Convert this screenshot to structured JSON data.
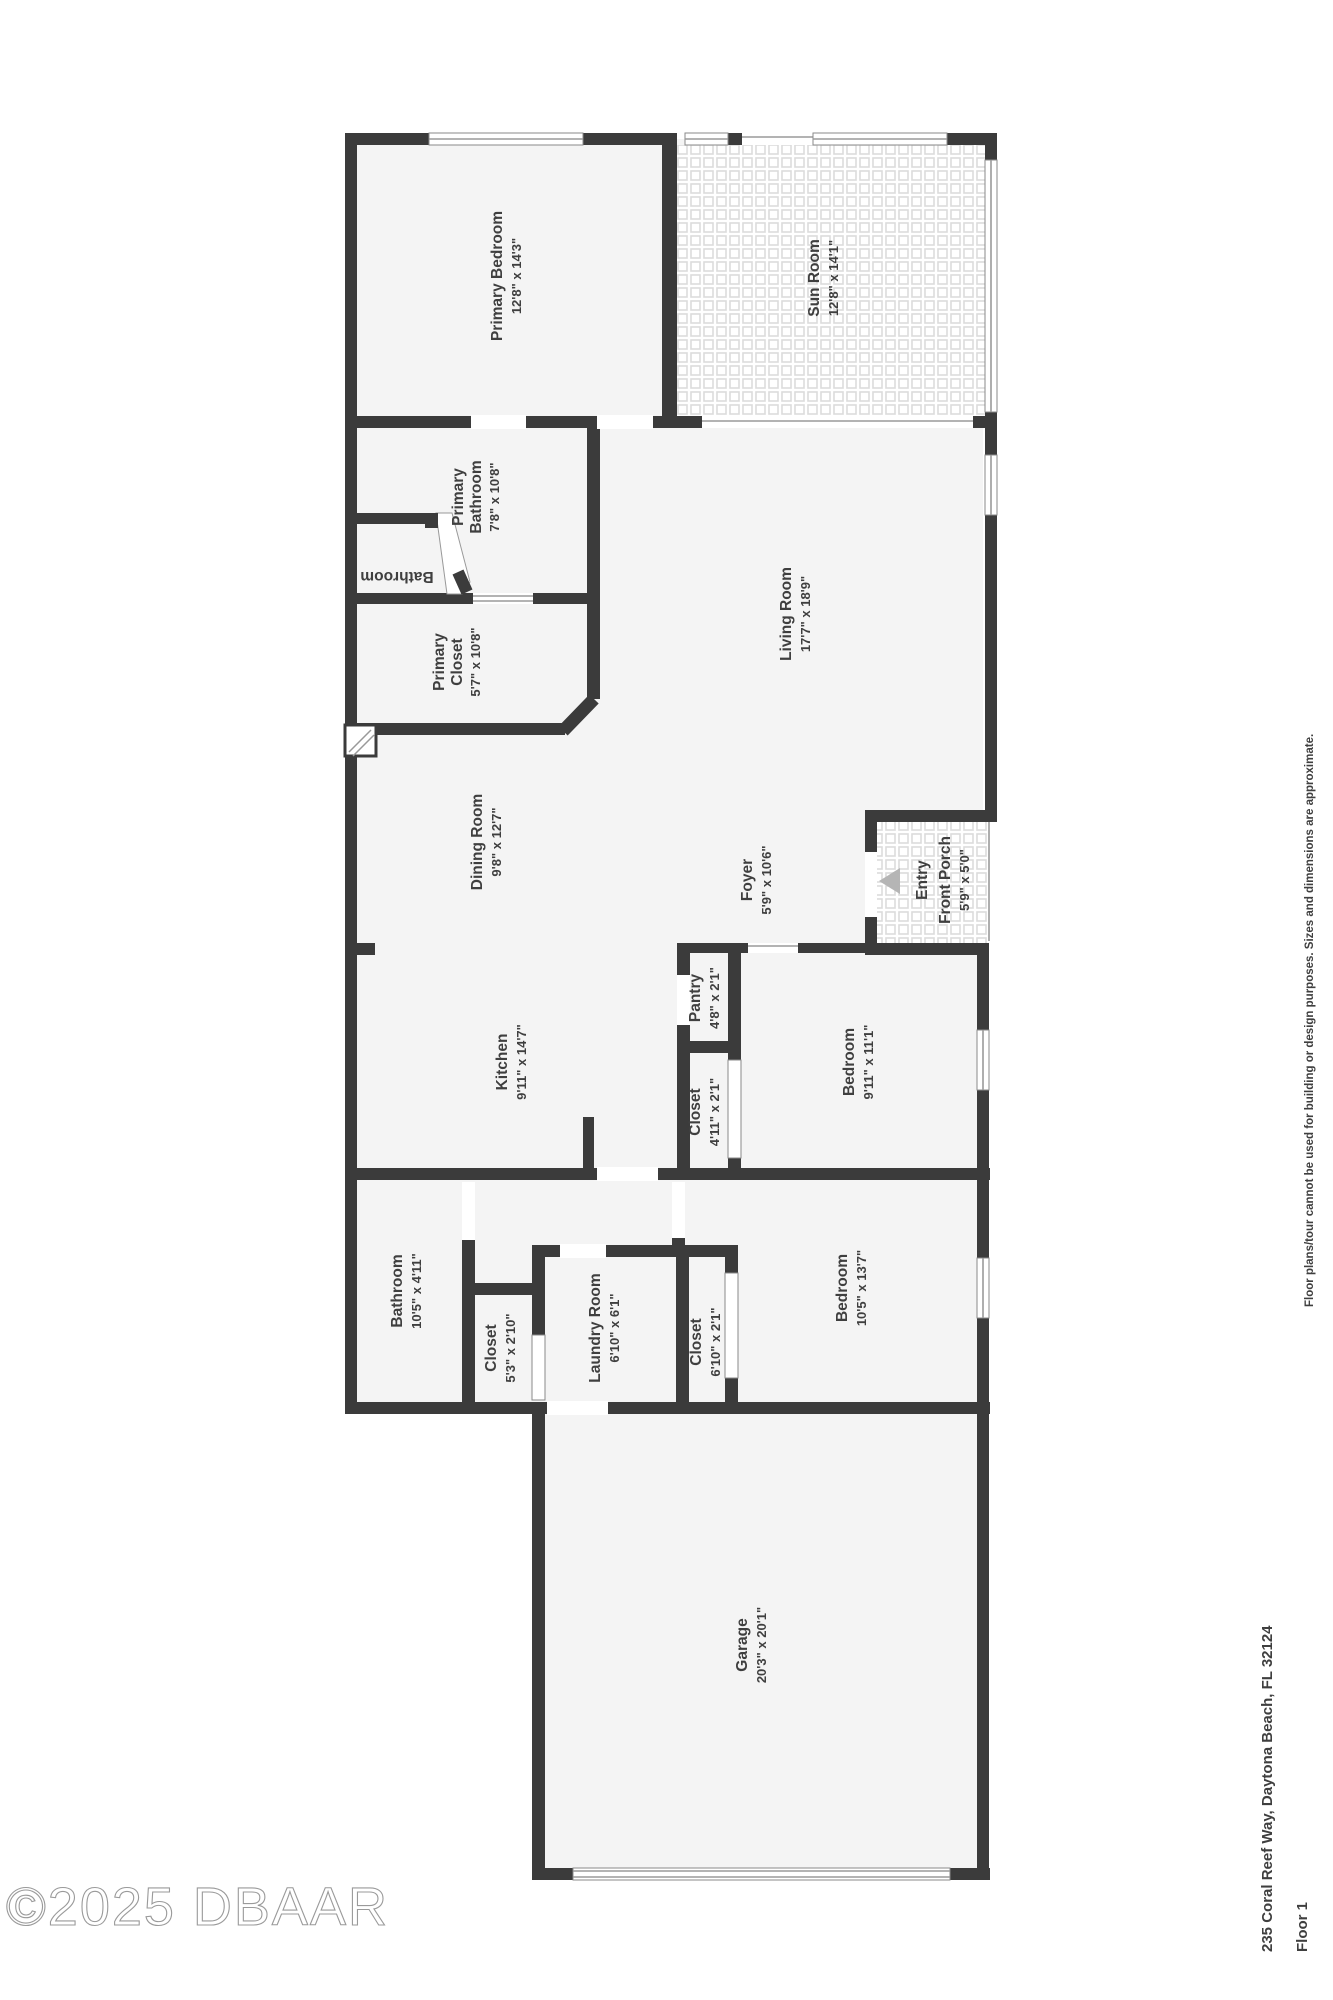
{
  "colors": {
    "wall": "#3b3b3b",
    "floor": "#f4f4f4",
    "tile_line": "#dcdcdc",
    "label": "#3f3f3f",
    "entry_arrow": "#b5b5b5"
  },
  "rooms": {
    "primary_bedroom": {
      "name": "Primary Bedroom",
      "dims": "12'8\" x 14'3\""
    },
    "sun_room": {
      "name": "Sun Room",
      "dims": "12'8\" x 14'1\""
    },
    "primary_bathroom": {
      "name": "Primary",
      "name2": "Bathroom",
      "dims": "7'8\" x 10'8\""
    },
    "wc_bathroom": {
      "name": "Bathroom"
    },
    "primary_closet": {
      "name": "Primary",
      "name2": "Closet",
      "dims": "5'7\" x 10'8\""
    },
    "living_room": {
      "name": "Living Room",
      "dims": "17'7\" x 18'9\""
    },
    "dining_room": {
      "name": "Dining Room",
      "dims": "9'8\" x 12'7\""
    },
    "foyer": {
      "name": "Foyer",
      "dims": "5'9\" x 10'6\""
    },
    "entry": {
      "name": "Entry"
    },
    "front_porch": {
      "name": "Front Porch",
      "dims": "5'9\" x 5'0\""
    },
    "kitchen": {
      "name": "Kitchen",
      "dims": "9'11\" x 14'7\""
    },
    "pantry": {
      "name": "Pantry",
      "dims": "4'8\" x 2'1\""
    },
    "closet_bed1": {
      "name": "Closet",
      "dims": "4'11\" x 2'1\""
    },
    "bedroom1": {
      "name": "Bedroom",
      "dims": "9'11\" x 11'1\""
    },
    "bathroom2": {
      "name": "Bathroom",
      "dims": "10'5\" x 4'11\""
    },
    "closet_hall": {
      "name": "Closet",
      "dims": "5'3\" x 2'10\""
    },
    "laundry": {
      "name": "Laundry Room",
      "dims": "6'10\" x 6'1\""
    },
    "closet_bed2": {
      "name": "Closet",
      "dims": "6'10\" x 2'1\""
    },
    "bedroom2": {
      "name": "Bedroom",
      "dims": "10'5\" x 13'7\""
    },
    "garage": {
      "name": "Garage",
      "dims": "20'3\" x 20'1\""
    }
  },
  "footer": {
    "watermark": "©2025 DBAAR",
    "address": "235 Coral Reef Way, Daytona Beach, FL 32124",
    "floor": "Floor 1",
    "disclaimer": "Floor plans/tour cannot be used for building or design purposes. Sizes and dimensions are approximate."
  }
}
